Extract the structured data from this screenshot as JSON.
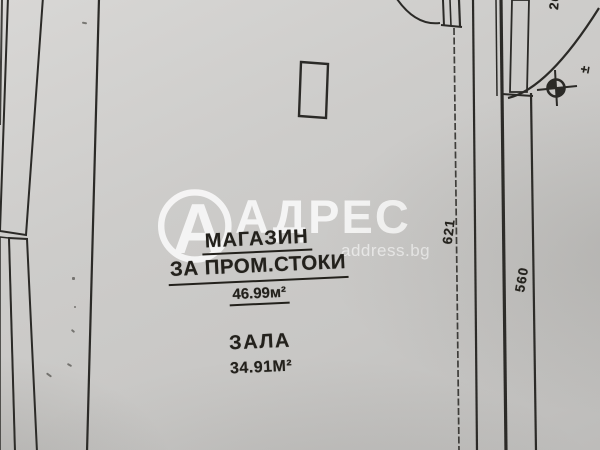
{
  "colors": {
    "paper": "#cdccca",
    "paper_dark": "#bdbcba",
    "ink": "#2b2a27",
    "text_ink": "#23211c",
    "glass": "#b3b1a6",
    "wm": "#ffffff"
  },
  "watermark": {
    "brand": "АДРЕС",
    "site": "address.bg",
    "logo_letter": "А"
  },
  "plan": {
    "rooms": [
      {
        "name": "МАГАЗИН",
        "name2": "ЗА ПРОМ.СТОКИ",
        "area": "46.99м²"
      },
      {
        "name": "ЗАЛА",
        "area": "34.91М²"
      }
    ],
    "dimensions": {
      "right_inner": "621",
      "right_outer": "560",
      "top_partial": "26"
    },
    "elevation_mark": "±"
  }
}
